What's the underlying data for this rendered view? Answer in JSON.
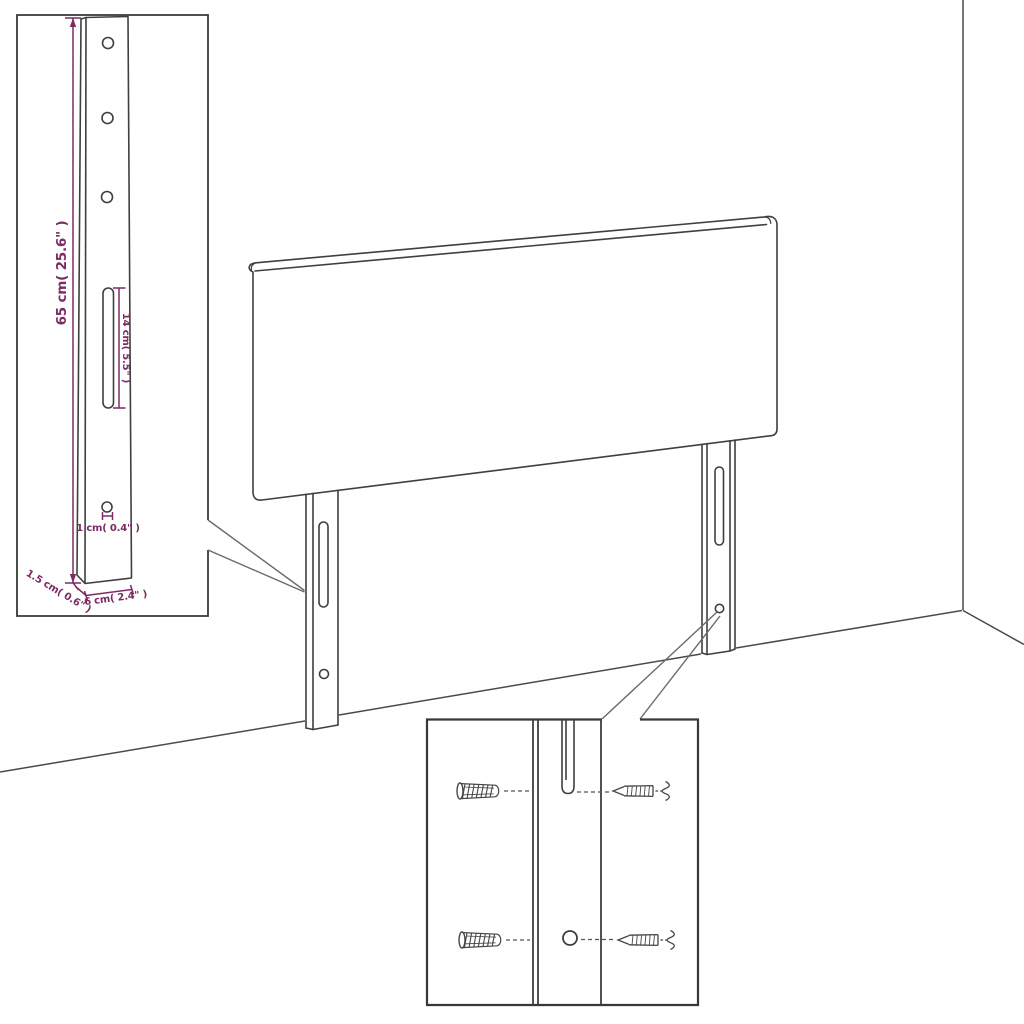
{
  "diagram": {
    "colors": {
      "line": "#3f3f3f",
      "box_border": "#383838",
      "dimension": "#7c2b64",
      "callout": "#6a6a6a",
      "background": "#ffffff"
    },
    "leg_detail_inset": {
      "height_label": "65 cm( 25.6\" )",
      "slot_label": "14 cm( 5.5\" )",
      "hole_label": "1 cm( 0.4\" )",
      "depth_label": "1.5 cm( 0.6\" )",
      "width_label": "6 cm( 2.4\" )"
    }
  }
}
